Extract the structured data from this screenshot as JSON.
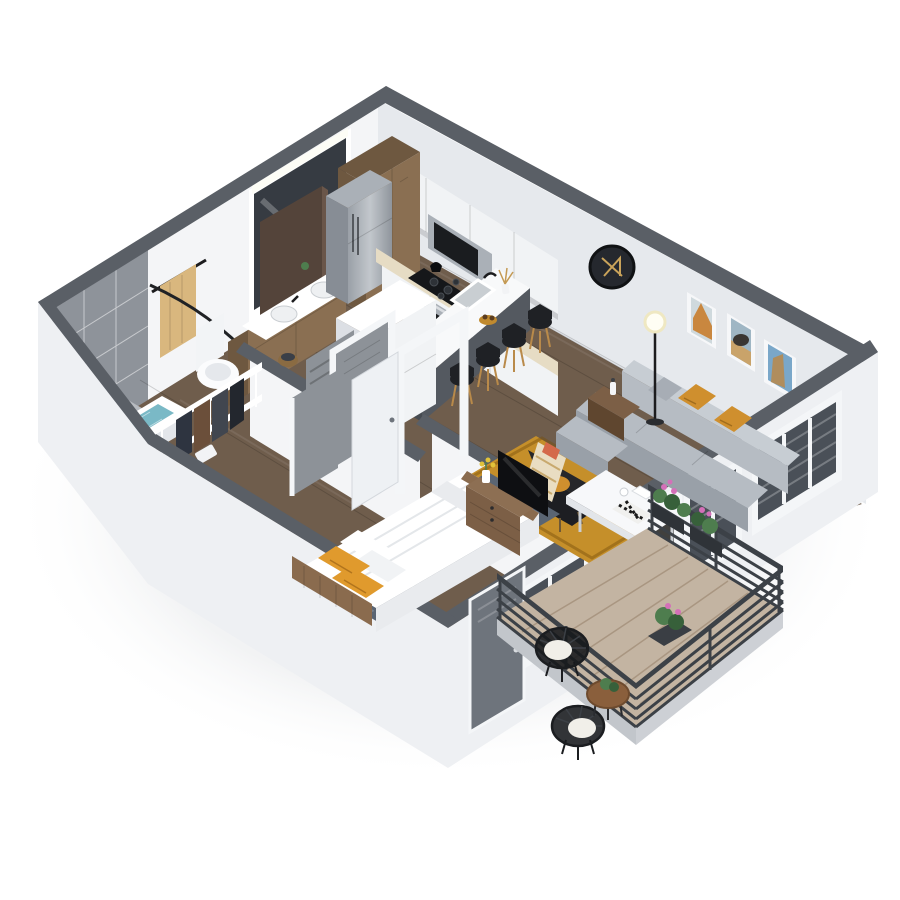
{
  "image": {
    "kind": "isometric 3D floor plan rendering",
    "style": "photoreal dollhouse cutaway, one-bedroom apartment with balcony",
    "background": "#ffffff"
  },
  "colors": {
    "wall_top": "#5a5f66",
    "wall_face": "#f4f5f7",
    "wall_face_shade": "#e6e9ed",
    "wall_ext": "#eef0f3",
    "wall_ext_dark": "#dcdfe4",
    "floor_wood": "#6f5d4c",
    "floor_wood_dark": "#594b3e",
    "tile_wall": "#8e939a",
    "tile_floor": "#b7bbc0",
    "water": "#7ab9c6",
    "towel": "#d9b77e",
    "wood_cab": "#8a6f52",
    "wood_cab_dark": "#6e5840",
    "steel": "#aab0b7",
    "steel_dark": "#878d95",
    "white_gloss": "#f1f3f5",
    "counter": "#e6dcc4",
    "island_top": "#f8f9fa",
    "island_base": "#545960",
    "stool": "#1f2125",
    "stool_leg": "#b98a4a",
    "sofa": "#b6bcc3",
    "sofa_dark": "#99a0a8",
    "sofa_light": "#c7cdd3",
    "mustard": "#cf8f2e",
    "gray_pillow": "#a7adb5",
    "rug": "#c58f2a",
    "chair_black": "#26272b",
    "cream": "#e9ddc2",
    "table_white": "#f7f8fa",
    "wood": "#7c5f46",
    "wood_dark": "#5f462f",
    "tv": "#0e0f12",
    "duvet": "#ffffff",
    "duvet_shade": "#e9ebee",
    "orange": "#e09a2d",
    "bed_rug": "#5a6573",
    "bed_frame": "#8a6b4e",
    "deck": "#c3b4a2",
    "slab": "#cdd0d5",
    "railing": "#3c4147",
    "green": "#4e7d4e",
    "green_dark": "#37603a",
    "pink": "#d470b8",
    "door_brown": "#54443a",
    "door_gray": "#8d9298",
    "frame": "#f4f6f8",
    "mirror": "#363b42",
    "glass": "#4a5058",
    "white": "#ffffff"
  },
  "rooms": [
    {
      "id": "kitchen",
      "furniture": [
        "wood-pantry-cabinets",
        "stainless-refrigerator",
        "white-upper-cabinets",
        "microwave",
        "cooktop-with-oven",
        "counter-run",
        "island-with-sink",
        "bar-stools-x4",
        "gold-fruit-bowl",
        "dried-plant-vase"
      ]
    },
    {
      "id": "bathroom",
      "furniture": [
        "double-sink-wood-vanity",
        "wall-mirror-with-light",
        "toilet",
        "bathtub-with-water",
        "gray-tile-shower",
        "curved-curtain-rod",
        "tan-towel-on-bar"
      ]
    },
    {
      "id": "walk-in-closet",
      "furniture": [
        "white-wire-shelving",
        "hanging-clothes",
        "folded-linens",
        "laundry-basket"
      ]
    },
    {
      "id": "laundry-closet",
      "furniture": [
        "stacked-washer-dryer",
        "louvered-door"
      ]
    },
    {
      "id": "living-room",
      "furniture": [
        "gray-sofa-with-chaise",
        "mustard-pillows-x2",
        "gray-pillow",
        "black-accent-chair",
        "striped-throw-blanket",
        "wood-side-table",
        "floor-lamp",
        "mustard-area-rug",
        "framed-art-x3",
        "round-black-mirror",
        "white-dining-table",
        "chess-board"
      ]
    },
    {
      "id": "bedroom",
      "furniture": [
        "queen-bed-white-duvet",
        "orange-pillows-x2",
        "wood-headboard",
        "patterned-rug",
        "dresser",
        "flat-screen-tv",
        "flower-vase"
      ]
    },
    {
      "id": "balcony",
      "furniture": [
        "wood-plank-deck",
        "black-metal-railing",
        "wire-lounge-chairs-x2",
        "white-cushions",
        "round-wood-table",
        "potted-plant",
        "flower-planters"
      ]
    }
  ],
  "doors": [
    "brown-bathroom-door",
    "gray-bedroom-door",
    "gray-closet-door",
    "louvered-laundry-door",
    "white-entry-door",
    "white-french-balcony-door",
    "gray-bedroom-balcony-door"
  ],
  "windows": [
    "living-window-3-pane",
    "dining-window-2-pane",
    "bedroom-window-3-pane"
  ]
}
